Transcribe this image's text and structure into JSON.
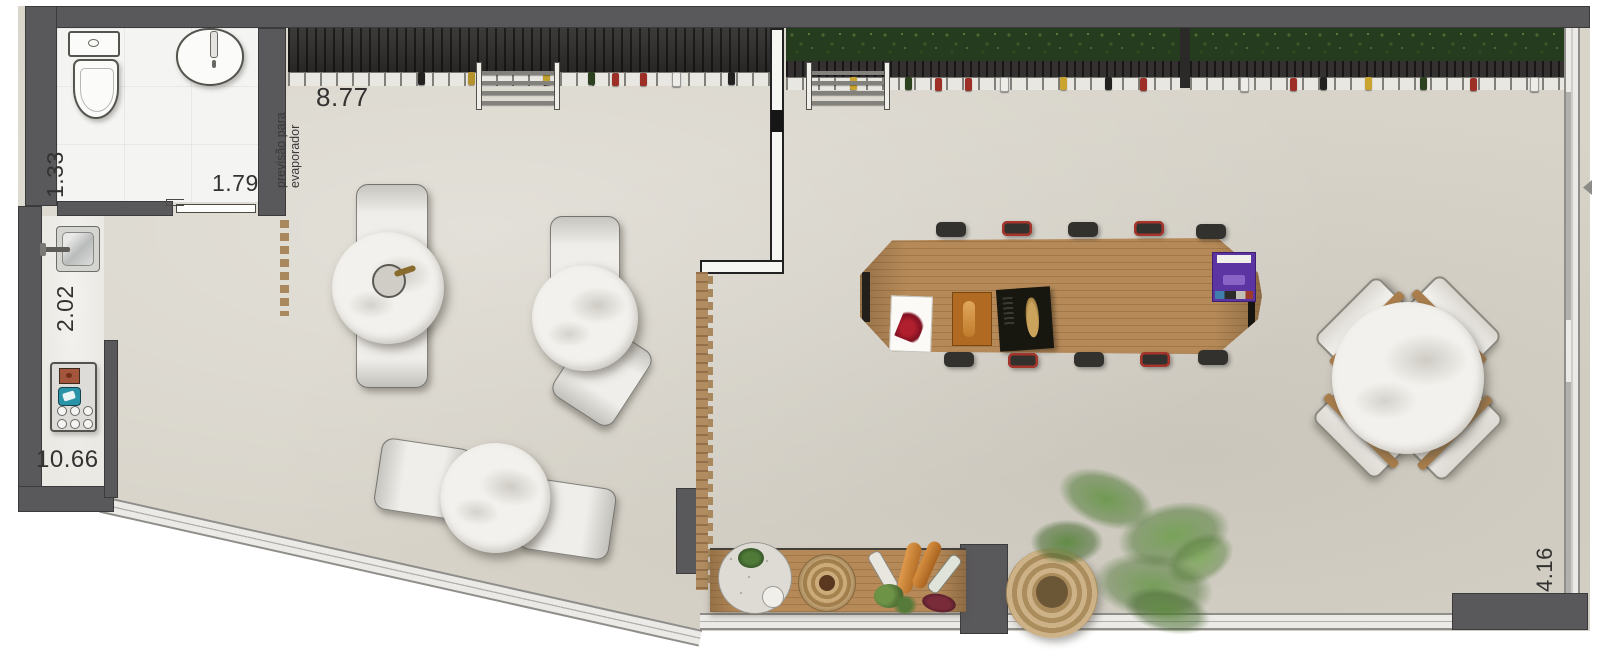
{
  "plan": {
    "dimensions": {
      "bathroom_width": "1.33",
      "bathroom_door": "1.79",
      "kitchenette_depth": "2.02",
      "left_side_length": "10.66",
      "top_bar_length": "8.77",
      "right_side_length": "4.16"
    },
    "notes": {
      "evaporator_line1": "previsão para",
      "evaporator_line2": "evaporador"
    },
    "palette": {
      "wall_gray": "#59585a",
      "floor_concrete": "#d8d4ca",
      "bathroom_floor": "#f4f4f2",
      "charcoal_shelf": "#2f2d2b",
      "hedge_green": "#253c1e",
      "wood_tan": "#b68a58",
      "marble_white": "#f3f1ed",
      "stool_red": "#a5342a",
      "book_purple": "#5d35a2",
      "book_orange": "#b06a22",
      "glass_window": "#eceae6"
    },
    "elements": [
      "toilet",
      "washbasin",
      "sliding-door",
      "kitchen-sink",
      "cooktop",
      "bar-shelf",
      "bottle-rail",
      "ladder",
      "hedge-planter",
      "partition-wall",
      "wood-slat-screen",
      "lounge-bench",
      "marble-table",
      "communal-wood-table",
      "bar-stool",
      "cross-chair-table",
      "sideboard",
      "bread-platter",
      "woven-basket",
      "potted-plant",
      "glass-facade",
      "column"
    ]
  }
}
